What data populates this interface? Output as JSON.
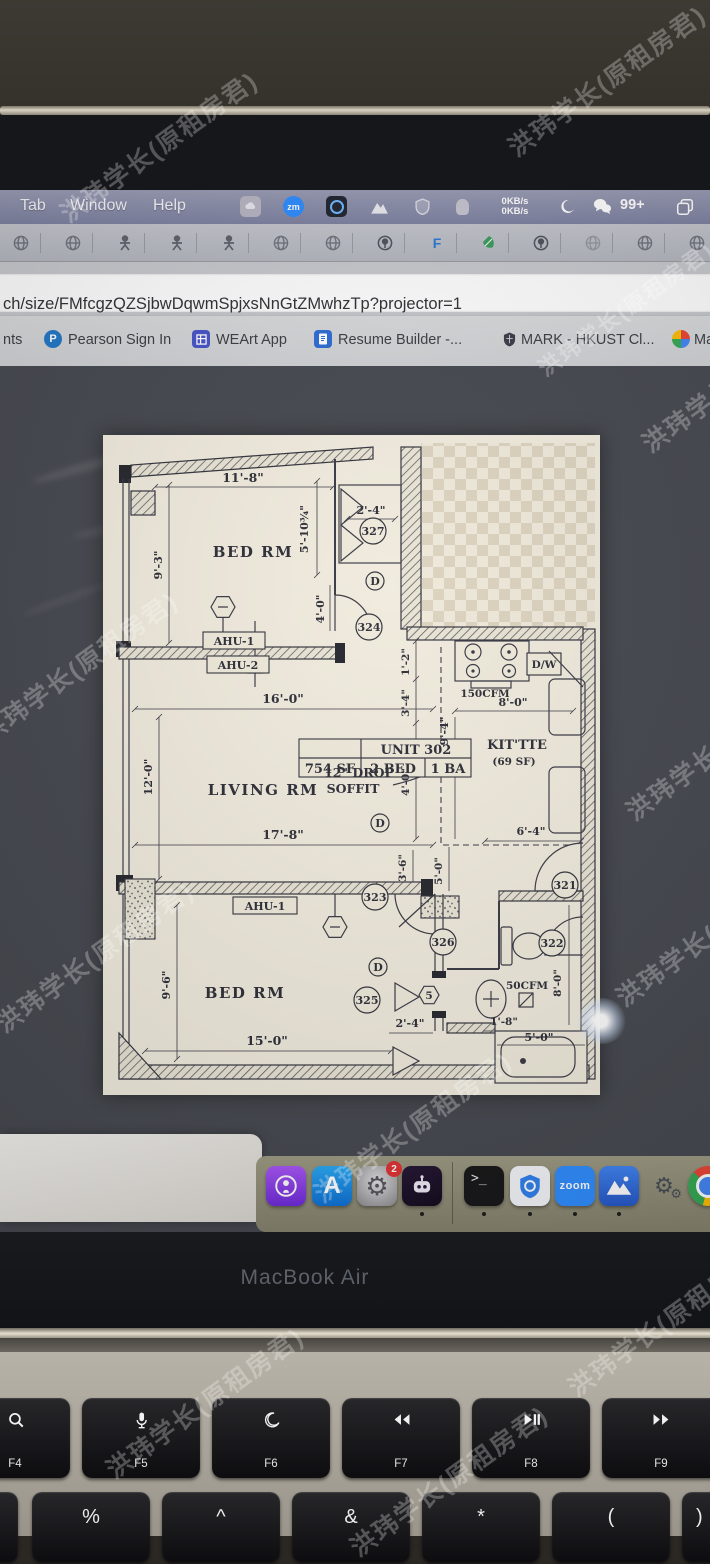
{
  "watermark": {
    "text": "洪玮学长(原租房君)"
  },
  "menu_bar": {
    "menus": [
      "Tab",
      "Window",
      "Help"
    ],
    "net_up": "0KB/s",
    "net_down": "0KB/s",
    "zm_label": "zm",
    "wechat_badge": "99+",
    "status_icons": [
      "app-gray",
      "zoom-app",
      "recorder",
      "mountain",
      "shield",
      "hand"
    ]
  },
  "extensions_bar": {
    "icons": [
      "globe",
      "globe",
      "person",
      "person",
      "person",
      "globe",
      "globe",
      "globe-pin",
      "letter-f",
      "leaf",
      "globe-pin",
      "globe",
      "globe",
      "globe"
    ],
    "letter_f": "F"
  },
  "url_bar": {
    "url": "ch/size/FMfcgzQZSjbwDqwmSpjxsNnGtZMwhzTp?projector=1"
  },
  "bookmarks_bar": {
    "pearson_letter": "P",
    "items": [
      {
        "label": "nts"
      },
      {
        "label": "Pearson Sign In"
      },
      {
        "label": "WEArt App"
      },
      {
        "label": "Resume Builder -..."
      },
      {
        "label": "MARK - HKUST Cl..."
      },
      {
        "label": "Mai..."
      }
    ]
  },
  "floorplan": {
    "unit_table": {
      "title": "UNIT 302",
      "cells": [
        "754 SF",
        "2 BED",
        "1 BA"
      ]
    },
    "rooms": {
      "bed1": "BED RM",
      "living": "LIVING RM",
      "bed2": "BED RM",
      "kit": "KIT'TTE",
      "kit_sf": "(69 SF)"
    },
    "equip": {
      "ahu1": "AHU-1",
      "ahu2": "AHU-2",
      "ahu1b": "AHU-1",
      "dw": "D/W",
      "cfm150": "150CFM",
      "cfm50": "50CFM",
      "soffit_l1": "12\" DROP",
      "soffit_l2": "SOFFIT",
      "door": "D",
      "hex5": "5"
    },
    "bubbles": {
      "b321": "321",
      "b322": "322",
      "b323": "323",
      "b324": "324",
      "b325": "325",
      "b326": "326",
      "b327": "327"
    },
    "dims": {
      "d11_8": "11'-8\"",
      "d9_3": "9'-3\"",
      "d5_10": "5'-10¾\"",
      "d2_4a": "2'-4\"",
      "d4_0a": "4'-0\"",
      "d16_0": "16'-0\"",
      "d12_0": "12'-0\"",
      "d1_2": "1'-2\"",
      "d3_4": "3'-4\"",
      "d4_0b": "4'-0\"",
      "d9_4": "9'-4\"",
      "d8_0a": "8'-0\"",
      "d6_4": "6'-4\"",
      "d17_8": "17'-8\"",
      "d3_6": "3'-6\"",
      "d5_0a": "5'-0\"",
      "d9_6": "9'-6\"",
      "d15_0": "15'-0\"",
      "d2_4b": "2'-4\"",
      "d1_8": "1'-8\"",
      "d8_0b": "8'-0\"",
      "d5_0b": "5'-0\""
    }
  },
  "dock": {
    "apps": [
      "Podcasts",
      "App Store",
      "System Settings",
      "Chat Bot",
      "Terminal",
      "Security Shield",
      "Zoom",
      "Mountain Docs",
      "Loading Gears",
      "Chrome"
    ],
    "settings_badge": "2",
    "terminal_glyph": ">_",
    "zoom_label": "zoom",
    "appstore_letter": "A"
  },
  "bezel": {
    "brand": "MacBook Air"
  },
  "keyboard": {
    "fkeys": [
      {
        "label": "F4",
        "icon": "search"
      },
      {
        "label": "F5",
        "icon": "mic"
      },
      {
        "label": "F6",
        "icon": "moon"
      },
      {
        "label": "F7",
        "icon": "rewind"
      },
      {
        "label": "F8",
        "icon": "play-pause"
      },
      {
        "label": "F9",
        "icon": "fast-forward"
      }
    ],
    "symbols": [
      "%",
      "^",
      "&",
      "*",
      "(",
      ")"
    ]
  }
}
